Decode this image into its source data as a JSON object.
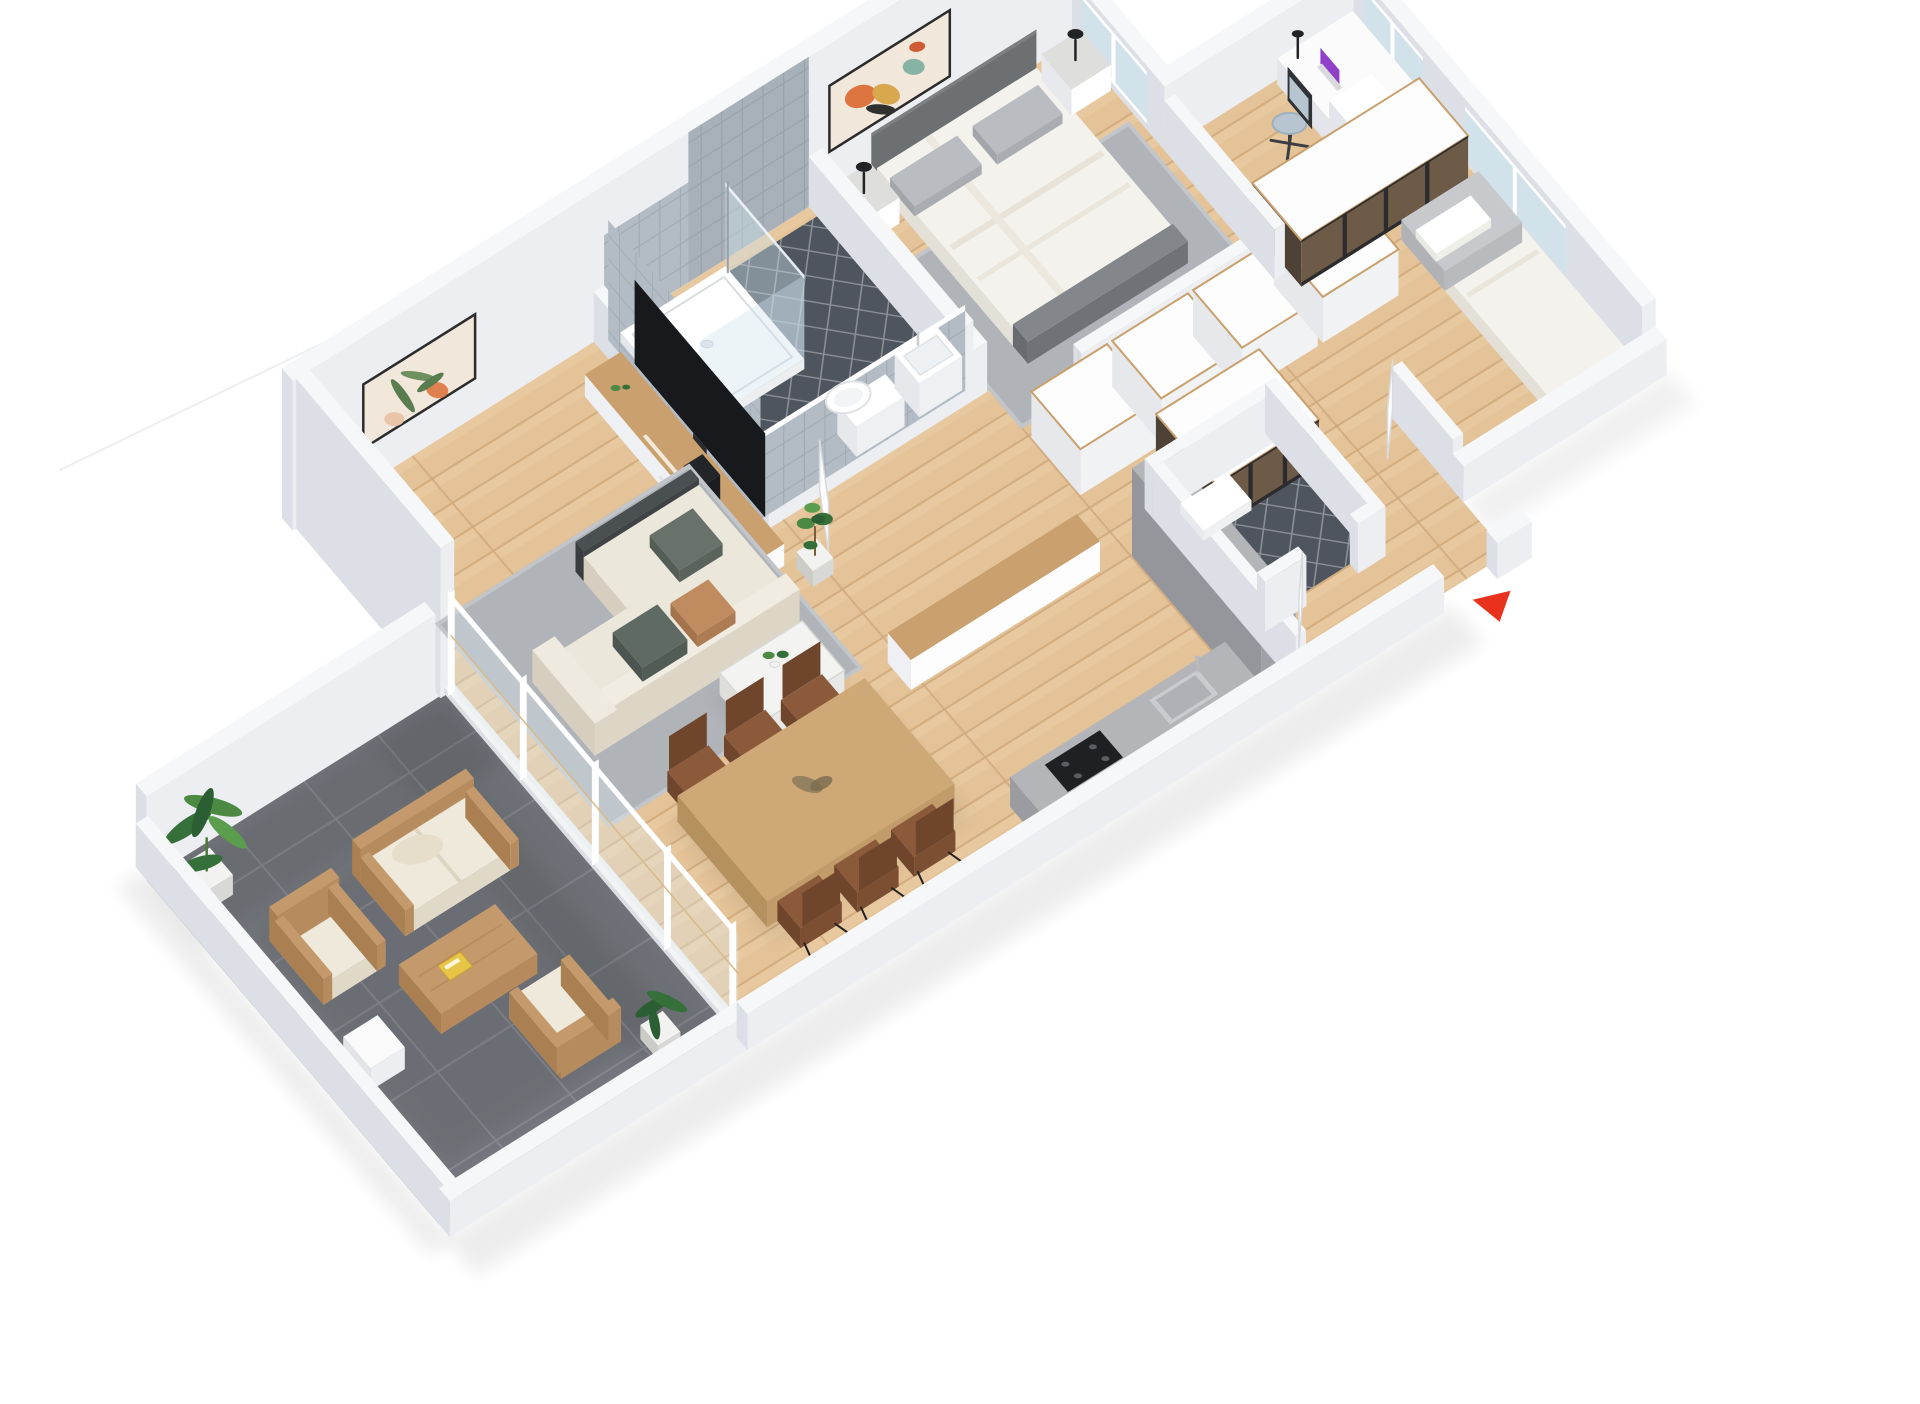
{
  "title": "3D isometric apartment floor plan render",
  "colors": {
    "background": "#ffffff",
    "wallTop": "#f6f7f9",
    "wallSide": "#eceef1",
    "wallSideDark": "#dcdfe5",
    "wallFace": "#f0f2f5",
    "floorWood": "#e4c398",
    "floorWoodLine": "#d2ad7f",
    "floorWoodJoint": "#cfa87b",
    "floorWoodLight": "#f0d7ae",
    "terraceTile": "#73767c",
    "terraceTileLine": "#85888e",
    "bathFloor": "#4f555e",
    "bathFloorLine": "#8b9097",
    "bathWallTile": "#b3bcc4",
    "bathWallTileLine": "#a2abb4",
    "rugGray": "#b0b4b8",
    "rugLight": "#c2c6ca",
    "sofaCream": "#ece7db",
    "sofaShade": "#ddd6c6",
    "sofaDark": "#4a4f52",
    "pillowGreen": "#5f6a63",
    "pillowTan": "#c08c5f",
    "pillowSage": "#68726b",
    "woodFurn": "#c9a06e",
    "woodFurnDark": "#b68c5a",
    "tableTop": "#cfa878",
    "tableSide": "#c29b6a",
    "white": "#ffffff",
    "offWhite": "#fbfbfc",
    "tv": "#17191c",
    "tvStand": "#2a2c2f",
    "marble": "#f3f3f1",
    "marbleLine": "#d8d8d4",
    "marbleTop": "#dededc",
    "chairBrown": "#8a5a3a",
    "chairBrownDark": "#6f462c",
    "counterGray": "#b3b5b9",
    "counterGrayDark": "#9fa1a6",
    "counterGrayDeep": "#94969b",
    "hob": "#1e2023",
    "steel": "#c9cbce",
    "glassBlue": "#cfe2ec",
    "glassPane": "#dfeaf2",
    "glassBrown": "#6e5b47",
    "glassBrownDark": "#4e4136",
    "frameDark": "#2c2c2e",
    "bedDuvet": "#f4f2ed",
    "bedShadow": "#e3e0d8",
    "bedFoot": "#83868a",
    "headboard": "#6d7073",
    "pillowGray": "#b9bcc0",
    "blanketGray": "#c7c9cc",
    "lampBlack": "#222326",
    "plantGreen": "#4c8a44",
    "plantDark": "#35703a",
    "plantDeep": "#2c5e33",
    "potWhite": "#f2f2f0",
    "potGray": "#d8d8d6",
    "artCream": "#f1e7da",
    "artFrame": "#2b2b2b",
    "artOrange": "#de7440",
    "artYellow": "#d9a84e",
    "artTeal": "#87b3a5",
    "artDark": "#30302e",
    "artGreen": "#5a7d50",
    "artLeaf": "#6e8f5e",
    "artPeach": "#e8c4a8",
    "chairBlue": "#b6c5cf",
    "chairBack": "#2f3237",
    "deskWhite": "#fbfbfc",
    "arrowRed": "#e8321e",
    "laptopPurple": "#9040c8",
    "laptopBase": "#d8dadd",
    "doorWhite": "#fcfcfd",
    "doorEdge": "#d8dade",
    "outCushion": "#efe9dc",
    "outCushionShade": "#e0d9c8",
    "outWood": "#c49a6c",
    "outWoodDark": "#aa8052",
    "bookYellow": "#e8c547",
    "rope": "#d8b98a",
    "shadow": "#1a1a1a"
  },
  "scene": {
    "view": "isometric-dollhouse",
    "rooms": [
      {
        "name": "master-bedroom",
        "furniture": [
          "double-bed",
          "headboard",
          "pillows",
          "nightstand-left",
          "nightstand-right",
          "table-lamps",
          "area-rug",
          "abstract-artwork",
          "window"
        ]
      },
      {
        "name": "bathroom",
        "furniture": [
          "shower-tray",
          "shower-glass",
          "wall-hung-toilet",
          "washbasin",
          "tiled-walls",
          "dark-tile-floor"
        ]
      },
      {
        "name": "living-room",
        "furniture": [
          "l-shaped-sofa",
          "throw-pillows",
          "coffee-table",
          "table-plant",
          "media-unit",
          "tv",
          "fiddle-leaf-plant",
          "botanical-artwork",
          "area-rug"
        ]
      },
      {
        "name": "dining-area",
        "furniture": [
          "dining-table",
          "dining-chairs-x6",
          "centerpiece"
        ]
      },
      {
        "name": "kitchen",
        "furniture": [
          "breakfast-bar",
          "tall-cabinet",
          "counter-run",
          "sink",
          "faucet",
          "cooktop"
        ]
      },
      {
        "name": "corridor-dressing",
        "furniture": [
          "white-wardrobe-row",
          "smoked-glass-wardrobe"
        ]
      },
      {
        "name": "desk-nook",
        "furniture": [
          "desk",
          "drawer-unit",
          "laptop",
          "desk-lamp",
          "office-chair",
          "windows"
        ]
      },
      {
        "name": "second-bedroom",
        "furniture": [
          "single-bed",
          "gray-blanket",
          "smoked-glass-wardrobe",
          "door",
          "windows"
        ]
      },
      {
        "name": "wc",
        "furniture": [
          "dark-tile-floor",
          "bath-mat",
          "door"
        ]
      },
      {
        "name": "entrance",
        "furniture": [
          "door-opening",
          "entrance-arrow-marker"
        ]
      },
      {
        "name": "terrace",
        "furniture": [
          "outdoor-loveseat",
          "outdoor-armchair-x2",
          "outdoor-coffee-table",
          "yellow-book",
          "side-cube",
          "banana-plant",
          "potted-plant",
          "glass-sliding-doors",
          "dark-tile-floor"
        ]
      }
    ],
    "entrance_marker": {
      "shape": "triangle",
      "color": "#e8321e"
    }
  }
}
